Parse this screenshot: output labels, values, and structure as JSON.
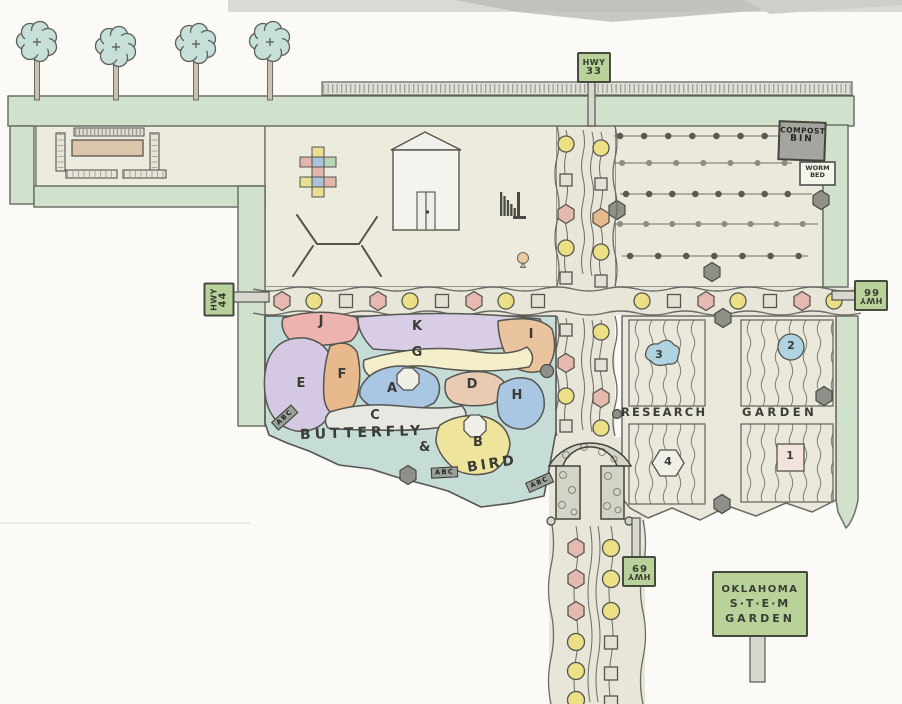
{
  "title": "Oklahoma S.T.E.M Garden site plan",
  "signs": {
    "hwy_north": {
      "line1": "HWY",
      "line2": "33"
    },
    "hwy_west": {
      "line1": "HWY",
      "line2": "44"
    },
    "hwy_east": {
      "line1": "HWY",
      "line2": "66"
    },
    "hwy_south": {
      "line1": "HWY",
      "line2": "69"
    },
    "compost_bin": {
      "line1": "COMPOST",
      "line2": "BIN"
    },
    "worm_bed": {
      "line1": "WORM",
      "line2": "BED"
    },
    "stem_sign": {
      "line1": "OKLAHOMA",
      "line2": "S·T·E·M",
      "line3": "GARDEN"
    },
    "row_marker": "ABC"
  },
  "butterfly_bird_garden": {
    "caption_word1": "BUTTERFLY",
    "caption_amp": "&",
    "caption_word2": "BIRD",
    "beds": [
      {
        "letter": "A",
        "color": "#a9c6e2"
      },
      {
        "letter": "B",
        "color": "#eee49c"
      },
      {
        "letter": "C",
        "color": "#e7e8e2"
      },
      {
        "letter": "D",
        "color": "#e9cbb4"
      },
      {
        "letter": "E",
        "color": "#d5c8e2"
      },
      {
        "letter": "F",
        "color": "#e8b98c"
      },
      {
        "letter": "G",
        "color": "#f4eecb"
      },
      {
        "letter": "H",
        "color": "#a9c6e2"
      },
      {
        "letter": "I",
        "color": "#eac49e"
      },
      {
        "letter": "J",
        "color": "#edb3ae"
      },
      {
        "letter": "K",
        "color": "#d8cde5"
      }
    ]
  },
  "research_garden": {
    "caption_word1": "RESEARCH",
    "caption_word2": "GARDEN",
    "plots": [
      {
        "number": "1",
        "marker_shape": "square",
        "marker_color": "#f3e3dd"
      },
      {
        "number": "2",
        "marker_shape": "circle",
        "marker_color": "#b0d3e2"
      },
      {
        "number": "3",
        "marker_shape": "cloud",
        "marker_color": "#b0d3e2"
      },
      {
        "number": "4",
        "marker_shape": "hexagon",
        "marker_color": "#f0efe8"
      }
    ]
  },
  "palette": {
    "paper": "#fbfaf6",
    "hedge_green": "#d0e2cc",
    "ground": "#edebde",
    "path": "#e8e6d9",
    "butterfly_background": "#c6dcd6",
    "sign_green": "#b8d29a",
    "tree_canopy": "#c7dfd9",
    "plant_pink": "#e5b9af",
    "plant_yellow": "#ece087",
    "paver_gray": "#e3e1d6",
    "stone_gray": "#90908a"
  }
}
